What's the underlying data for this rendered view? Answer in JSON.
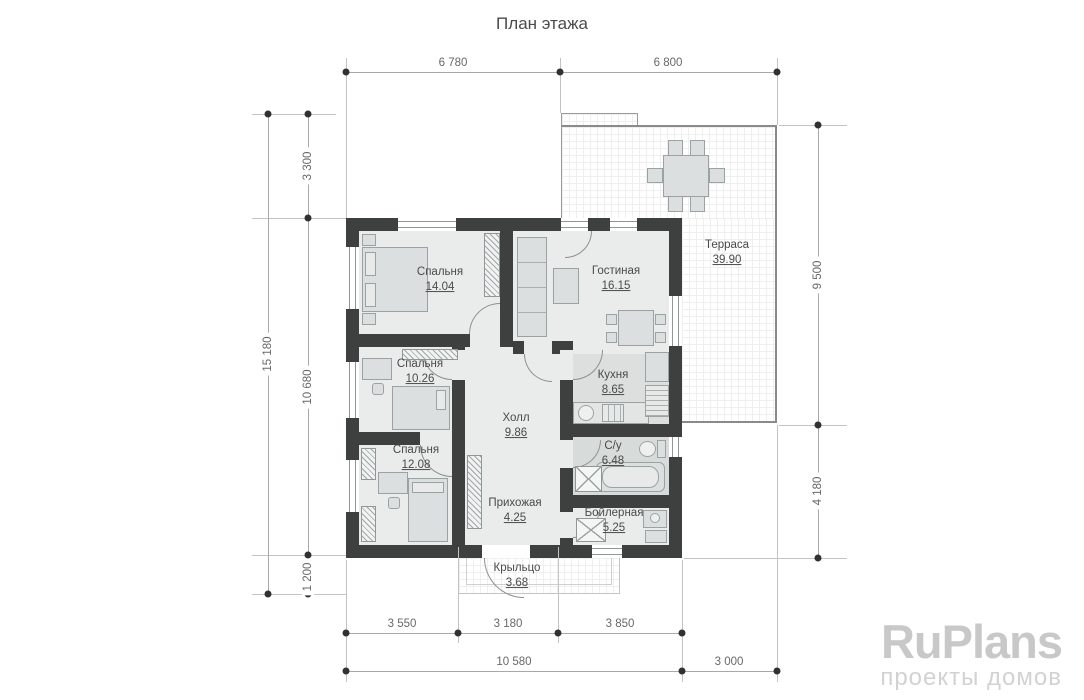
{
  "title": "План этажа",
  "rooms": {
    "bedroom1": {
      "name": "Спальня",
      "area": "14.04"
    },
    "living": {
      "name": "Гостиная",
      "area": "16.15"
    },
    "bedroom2": {
      "name": "Спальня",
      "area": "10.26"
    },
    "kitchen": {
      "name": "Кухня",
      "area": "8.65"
    },
    "hall": {
      "name": "Холл",
      "area": "9.86"
    },
    "bedroom3": {
      "name": "Спальня",
      "area": "12.08"
    },
    "bathroom": {
      "name": "С/у",
      "area": "6.48"
    },
    "entry": {
      "name": "Прихожая",
      "area": "4.25"
    },
    "boiler": {
      "name": "Бойлерная",
      "area": "5.25"
    },
    "porch": {
      "name": "Крыльцо",
      "area": "3.68"
    },
    "terrace": {
      "name": "Терраса",
      "area": "39.90"
    }
  },
  "dimensions": {
    "top_left": "6 780",
    "top_right": "6 800",
    "left_total": "15 180",
    "left_upper": "3 300",
    "left_middle": "10 680",
    "left_lower": "1 200",
    "right_upper": "9 500",
    "right_lower": "4 180",
    "bottom_a": "3 550",
    "bottom_b": "3 180",
    "bottom_c": "3 850",
    "bottom_total": "10 580",
    "bottom_right": "3 000"
  },
  "watermark": {
    "brand": "RuPlans",
    "tagline": "проекты домов"
  },
  "colors": {
    "wall": "#3e4040",
    "floor": "#eaeceb",
    "wet_floor": "#d7dbda",
    "dim_text": "#686868",
    "label_text": "#4a4a4a",
    "watermark": "#c8c8c8"
  }
}
